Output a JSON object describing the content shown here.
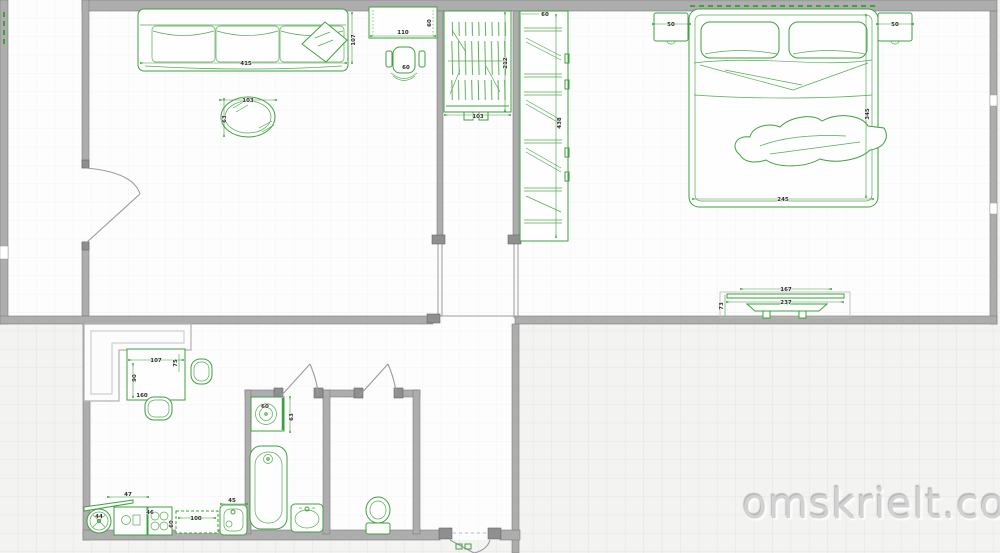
{
  "watermark": {
    "text": "omskrielt.com"
  },
  "colors": {
    "furniture_green": "#3fa03f",
    "wall_gray": "#adadad",
    "dim_text": "#2b2b2b",
    "watermark_text": "#d2d2d2",
    "canvas_background": "#f3f3f1",
    "grid_line": "#e4e4e2"
  },
  "rooms": {
    "living_room": {
      "labels": {
        "sofa_width": "415",
        "sofa_depth": "107",
        "desk_width": "110",
        "desk_depth": "60",
        "chair": "60",
        "table_width": "103",
        "table_depth": "63"
      }
    },
    "hallway": {
      "labels": {
        "closet_depth": "212",
        "closet_width": "103",
        "wardrobe_width": "60",
        "wardrobe_length": "438"
      }
    },
    "bedroom": {
      "labels": {
        "nightstand_left": "50",
        "nightstand_right": "50",
        "bed_width": "245",
        "bed_length": "345",
        "radiator_width": "167",
        "radiator_length": "237",
        "radiator_depth": "73"
      }
    },
    "kitchen": {
      "labels": {
        "table_width": "107",
        "table_depth": "75",
        "table_side": "90",
        "table_front": "160",
        "corner_counter": "47",
        "hood_fan": "44",
        "stove": "46",
        "counter_width": "100",
        "counter_depth": "60",
        "sink": "45",
        "washer": "60",
        "washer_depth": "63"
      }
    }
  }
}
